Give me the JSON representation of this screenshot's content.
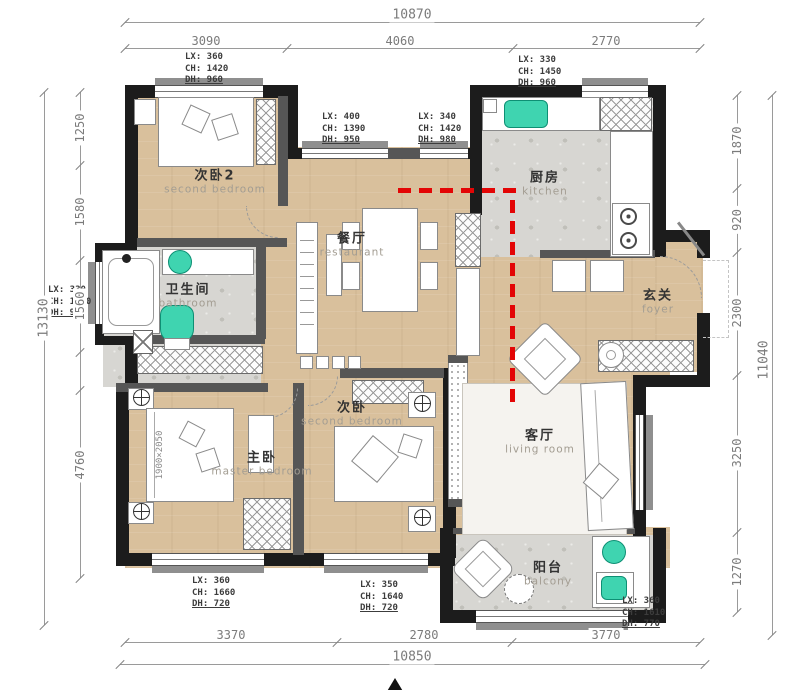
{
  "plan": {
    "rooms": {
      "bedroom2": {
        "cn": "次卧2",
        "en": "second bedroom"
      },
      "bathroom": {
        "cn": "卫生间",
        "en": "bathroom"
      },
      "dining": {
        "cn": "餐厅",
        "en": "restaurant"
      },
      "kitchen": {
        "cn": "厨房",
        "en": "kitchen"
      },
      "foyer": {
        "cn": "玄关",
        "en": "foyer"
      },
      "living": {
        "cn": "客厅",
        "en": "living room"
      },
      "master": {
        "cn": "主卧",
        "en": "master bedroom"
      },
      "bedroom3": {
        "cn": "次卧",
        "en": "second bedroom"
      },
      "balcony": {
        "cn": "阳台",
        "en": "balcony"
      }
    },
    "dimensions": {
      "top": {
        "total": "10870",
        "segments": [
          "3090",
          "4060",
          "2770"
        ]
      },
      "bottom": {
        "total": "10850",
        "segments": [
          "3370",
          "2780",
          "3770"
        ]
      },
      "left": {
        "total": "13130",
        "segments": [
          "1250",
          "1580",
          "1560",
          "4760"
        ]
      },
      "right": {
        "total": "11040",
        "segments": [
          "1870",
          "920",
          "2300",
          "3250",
          "1270"
        ]
      }
    },
    "window_tags": {
      "top_left": [
        "LX: 360",
        "CH: 1420",
        "DH: 960"
      ],
      "top_mid_left": [
        "LX: 400",
        "CH: 1390",
        "DH: 950"
      ],
      "top_mid_right": [
        "LX: 340",
        "CH: 1420",
        "DH: 980"
      ],
      "top_right": [
        "LX: 330",
        "CH: 1450",
        "DH: 960"
      ],
      "left_bath": [
        "LX: 330",
        "CH: 1460",
        "DH: 960"
      ],
      "bottom_left": [
        "LX: 360",
        "CH: 1660",
        "DH: 720"
      ],
      "bottom_mid": [
        "LX: 350",
        "CH: 1640",
        "DH: 720"
      ],
      "bottom_right": [
        "LX: 360",
        "CH: 1610",
        "DH: 770"
      ]
    },
    "furniture_labels": {
      "master_bed_size": "1900×2050"
    },
    "colors": {
      "accent_teal": "#3fd4b0",
      "path_red": "#e30505",
      "wall_black": "#1c1c1c",
      "floor_wood": "#d9c09c",
      "floor_tile": "#d7d6d2"
    }
  }
}
